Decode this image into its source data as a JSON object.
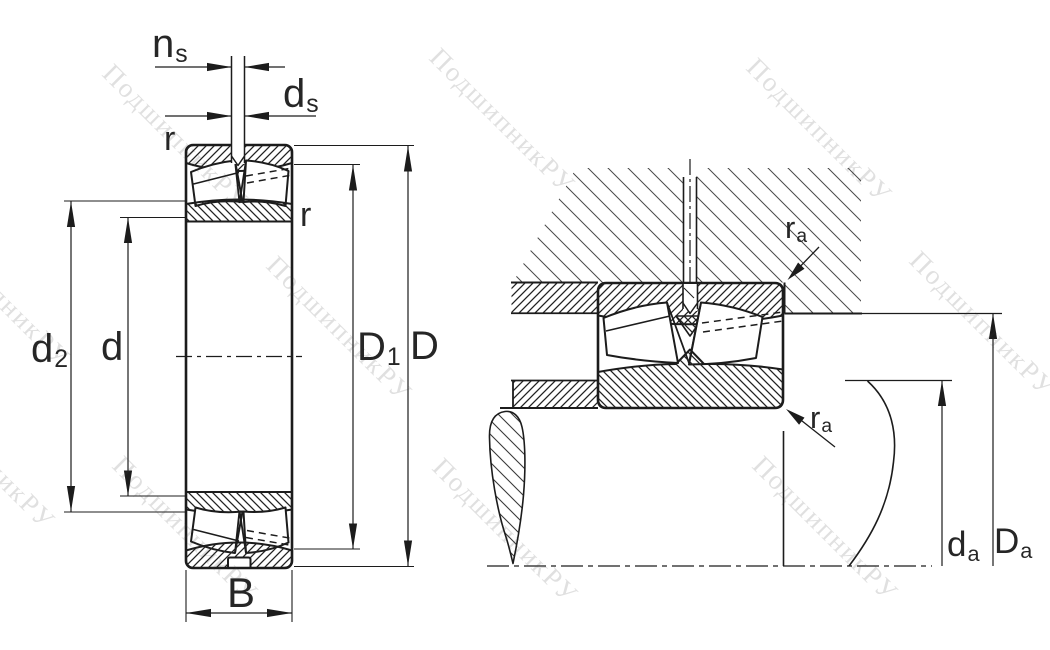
{
  "watermark": {
    "text": "ПодшипникРУ"
  },
  "labels": {
    "ns": {
      "base": "n",
      "sub": "s"
    },
    "ds": {
      "base": "d",
      "sub": "s"
    },
    "r_outer": {
      "base": "r",
      "sub": ""
    },
    "r_inner": {
      "base": "r",
      "sub": ""
    },
    "d2": {
      "base": "d",
      "sub": "2"
    },
    "d": {
      "base": "d",
      "sub": ""
    },
    "D1": {
      "base": "D",
      "sub": "1"
    },
    "D": {
      "base": "D",
      "sub": ""
    },
    "B": {
      "base": "B",
      "sub": ""
    },
    "ra_housing": {
      "base": "r",
      "sub": "a"
    },
    "ra_shaft": {
      "base": "r",
      "sub": "a"
    },
    "da": {
      "base": "d",
      "sub": "a"
    },
    "Da": {
      "base": "D",
      "sub": "a"
    }
  }
}
